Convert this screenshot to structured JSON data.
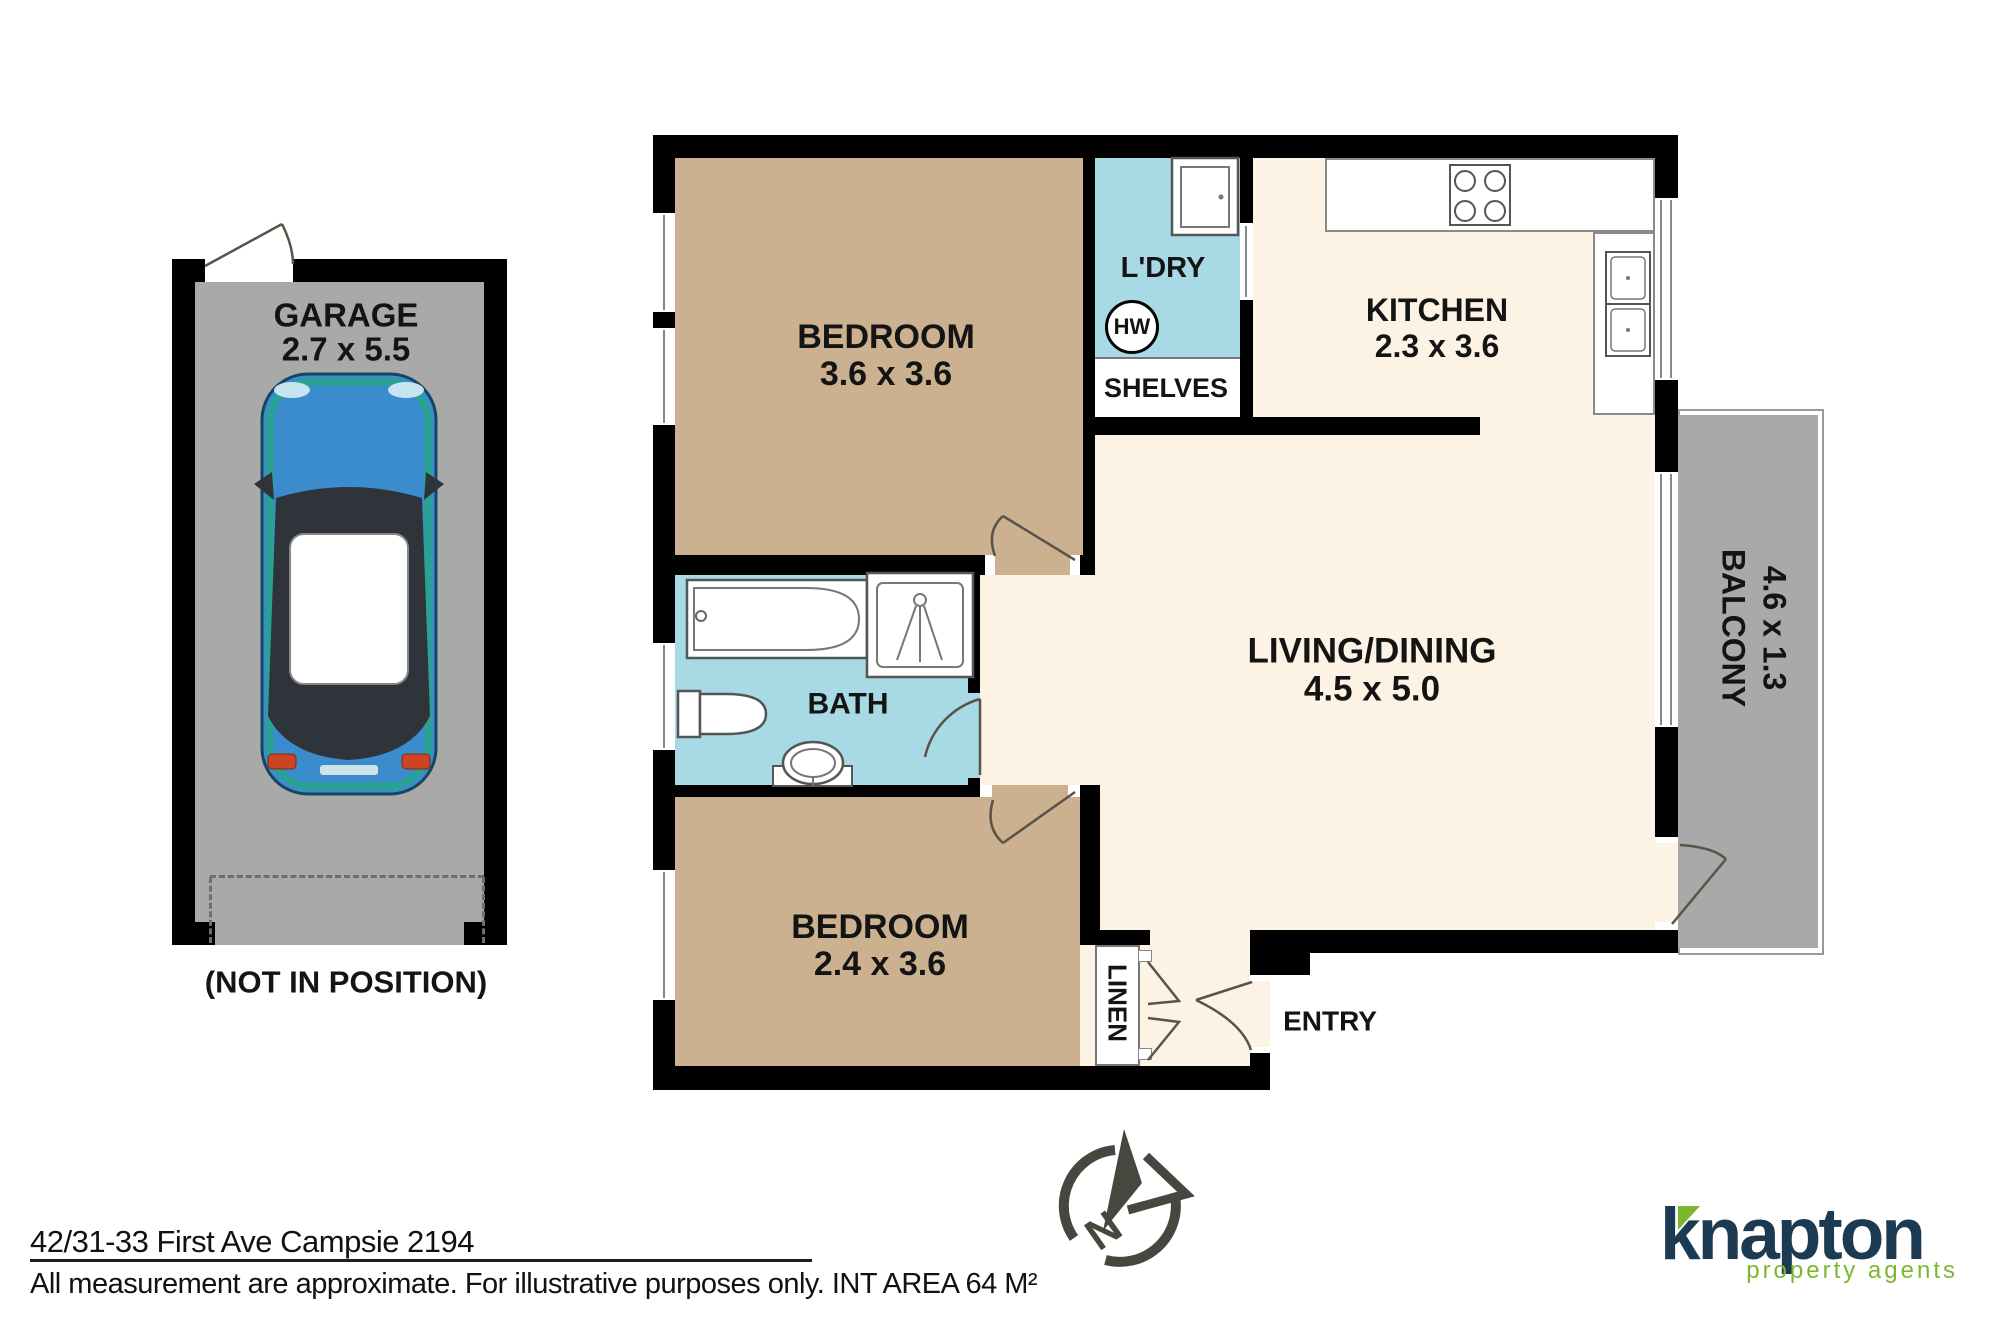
{
  "footer": {
    "address": "42/31-33 First Ave Campsie 2194",
    "disclaimer": "All measurement are approximate. For illustrative purposes only. INT AREA 64 M²"
  },
  "logo": {
    "brand": "knapton",
    "tagline": "property agents"
  },
  "compass": {
    "north_label": "N"
  },
  "garage": {
    "name": "GARAGE",
    "dims": "2.7 x 5.5",
    "note": "(NOT IN POSITION)"
  },
  "rooms": {
    "bedroom1": {
      "name": "BEDROOM",
      "dims": "3.6 x 3.6"
    },
    "bedroom2": {
      "name": "BEDROOM",
      "dims": "2.4 x 3.6"
    },
    "laundry": {
      "name": "L'DRY",
      "hw": "HW",
      "shelves": "SHELVES"
    },
    "kitchen": {
      "name": "KITCHEN",
      "dims": "2.3 x 3.6"
    },
    "living": {
      "name": "LIVING/DINING",
      "dims": "4.5 x 5.0"
    },
    "bath": {
      "name": "BATH"
    },
    "balcony": {
      "name": "BALCONY",
      "dims": "4.6 x 1.3"
    },
    "linen": {
      "name": "LINEN"
    },
    "entry": {
      "name": "ENTRY"
    }
  },
  "colors": {
    "wall": "#000000",
    "bedroom_fill": "#cbb190",
    "wet_area_fill": "#a7dae4",
    "living_fill": "#fdf3e4",
    "garage_fill": "#a9a9a9",
    "logo_navy": "#1c3b52",
    "logo_green": "#7cb82f",
    "compass_gray": "#47463f"
  }
}
